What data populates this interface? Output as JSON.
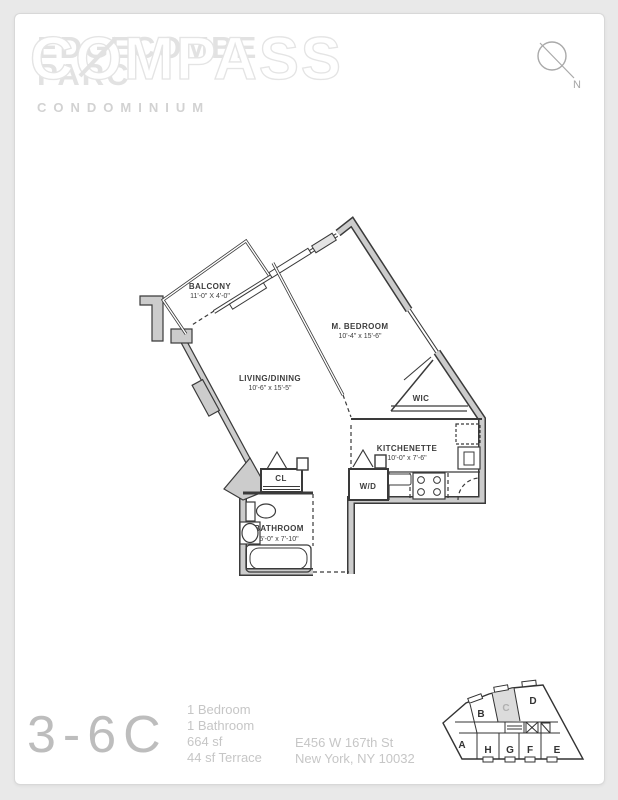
{
  "header": {
    "building_name_line1": "EDGECOMBE",
    "building_name_line2": "PARC",
    "brokerage_logo": "COMPASS",
    "building_type": "CONDOMINIUM",
    "north_label": "N"
  },
  "floorplan": {
    "rooms": [
      {
        "name": "BALCONY",
        "dims": "11'-0\" X 4'-0\""
      },
      {
        "name": "M. BEDROOM",
        "dims": "10'-4\" x 15'-6\""
      },
      {
        "name": "LIVING/DINING",
        "dims": "10'-6\" x 15'-5\""
      },
      {
        "name": "WIC",
        "dims": ""
      },
      {
        "name": "KITCHENETTE",
        "dims": "10'-0\" x 7'-6\""
      },
      {
        "name": "W/D",
        "dims": ""
      },
      {
        "name": "CL",
        "dims": ""
      },
      {
        "name": "BATHROOM",
        "dims": "5'-0\" x 7'-10\""
      }
    ]
  },
  "footer": {
    "unit_number": "3-6C",
    "stats": [
      "1 Bedroom",
      "1 Bathroom",
      "664 sf",
      "44 sf Terrace"
    ],
    "address_line1": "E456 W 167th St",
    "address_line2": "New York, NY 10032",
    "keyplan": {
      "units": [
        "A",
        "B",
        "C",
        "D",
        "H",
        "G",
        "F",
        "E"
      ],
      "highlighted_unit": "C"
    }
  },
  "colors": {
    "page_background": "#e9e9e9",
    "card_background": "#ffffff",
    "wall_fill": "#cccccc",
    "line": "#3a3a3a",
    "muted_text": "#c6c6c6",
    "keyplan_highlight": "#dcdcdc"
  }
}
